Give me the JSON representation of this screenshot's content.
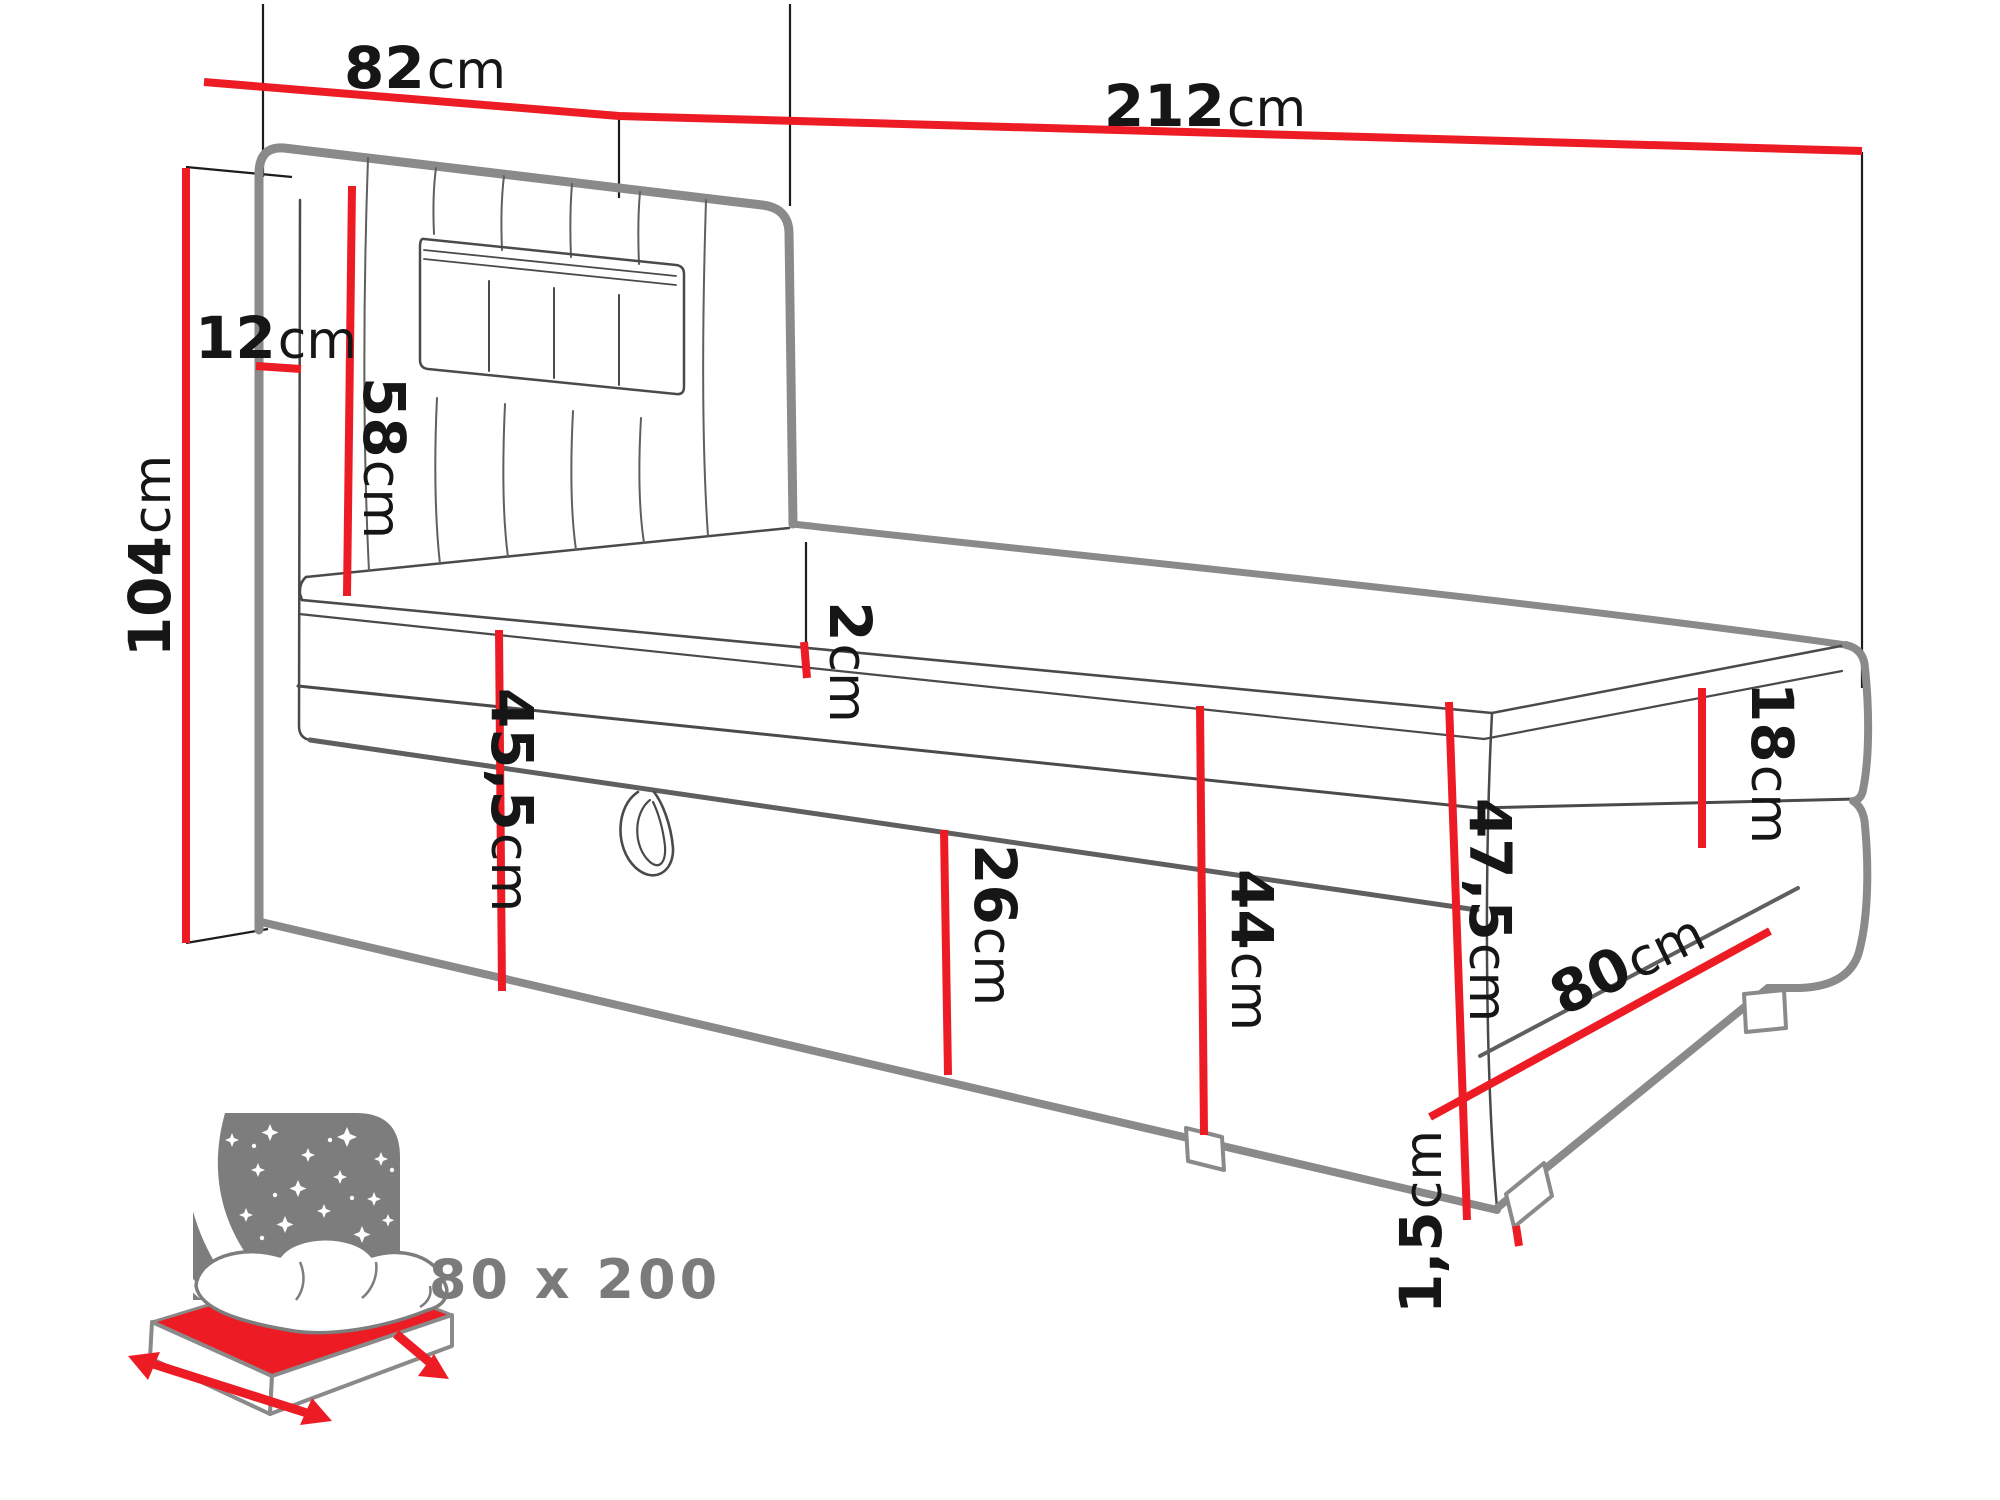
{
  "colors": {
    "dimension_red": "#ed1c24",
    "outline_gray": "#8a8a8a",
    "line_dark": "#4a4a4a",
    "label_black": "#161616",
    "badge_gray": "#7d7d7d",
    "badge_text_gray": "#7b7b7b"
  },
  "dimensions": {
    "headboard_width": {
      "value": "82",
      "unit": "cm"
    },
    "total_length": {
      "value": "212",
      "unit": "cm"
    },
    "headboard_height": {
      "value": "104",
      "unit": "cm"
    },
    "headboard_depth": {
      "value": "12",
      "unit": "cm"
    },
    "headboard_above_mattress": {
      "value": "58",
      "unit": "cm"
    },
    "topper_height": {
      "value": "2",
      "unit": "cm"
    },
    "front_box_height": {
      "value": "45,5",
      "unit": "cm"
    },
    "flap_height": {
      "value": "26",
      "unit": "cm"
    },
    "side_height": {
      "value": "44",
      "unit": "cm"
    },
    "mattress_height": {
      "value": "18",
      "unit": "cm"
    },
    "foot_end_height": {
      "value": "47,5",
      "unit": "cm"
    },
    "foot_width": {
      "value": "80",
      "unit": "cm"
    },
    "leg_height": {
      "value": "1,5",
      "unit": "cm"
    }
  },
  "badge": {
    "size_label": "80 x 200"
  }
}
